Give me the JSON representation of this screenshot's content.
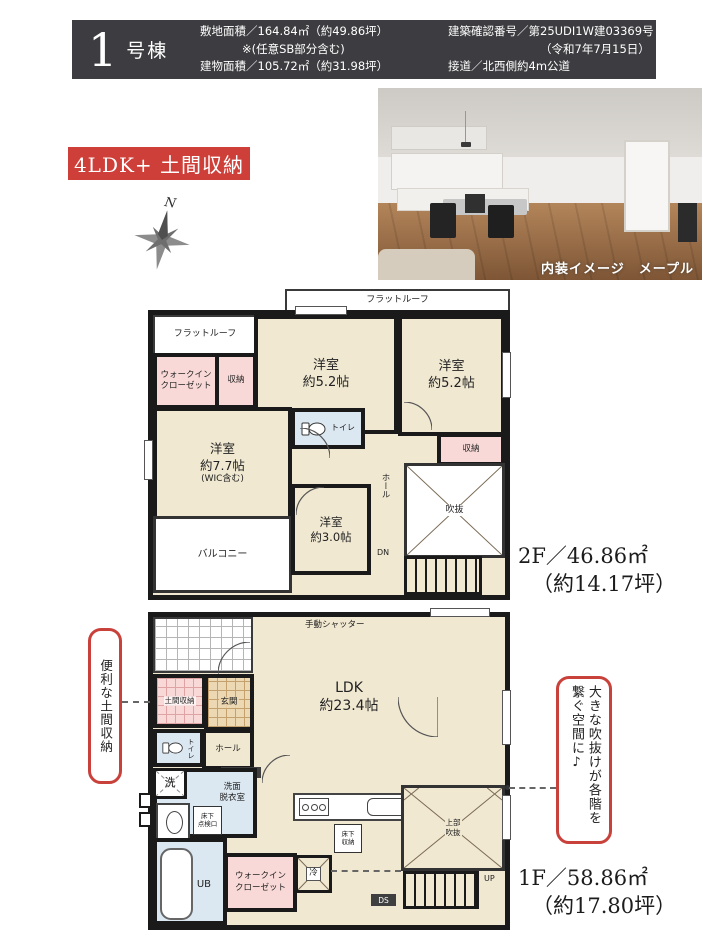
{
  "header": {
    "unit_number": "1",
    "unit_suffix": "号棟",
    "site_area": "敷地面積／164.84㎡（約49.86坪）",
    "site_area_note": "※(任意SB部分含む)",
    "building_area": "建物面積／105.72㎡（約31.98坪）",
    "confirm_no": "建築確認番号／第25UDI1W建03369号",
    "confirm_date": "（令和7年7月15日）",
    "road": "接道／北西側約4m公道"
  },
  "plan_badge": "4LDK+ 土間収納",
  "compass_n": "N",
  "photo_caption": "内装イメージ　メープル",
  "floor2": {
    "flat_roof_left": "フラットルーフ",
    "flat_roof_top": "フラットルーフ",
    "wic": "ウォークイン\nクローゼット",
    "closet_left": "収納",
    "bedroom52_left": "洋室\n約5.2帖",
    "bedroom52_right": "洋室\n約5.2帖",
    "toilet": "トイレ",
    "bedroom77": "洋室\n約7.7帖",
    "bedroom77_note": "(WIC含む)",
    "balcony": "バルコニー",
    "bedroom30": "洋室\n約3.0帖",
    "hall": "ホール",
    "closet_right": "収納",
    "void": "吹抜",
    "dn": "DN",
    "area1": "2F／46.86㎡",
    "area2": "（約14.17坪）"
  },
  "floor1": {
    "shutter": "手動シャッター",
    "ldk": "LDK\n約23.4帖",
    "doma": "土間収納",
    "genkan": "玄関",
    "toilet": "トイレ",
    "hall": "ホール",
    "genkan_storage": "玄関収納",
    "wash": "洗",
    "sanitary": "洗面\n脱衣室",
    "hatch": "床下\n点検口",
    "ub": "UB",
    "wic": "ウォークイン\nクローゼット",
    "fridge": "冷",
    "underfloor_storage": "床下\n収納",
    "void_upper": "上部\n吹抜",
    "up": "UP",
    "ds": "DS",
    "area1": "1F／58.86㎡",
    "area2": "（約17.80坪）"
  },
  "callout_left": "便利な土間収納",
  "callout_right": "大きな吹抜けが各階を繋ぐ空間に♪",
  "colors": {
    "accent_red": "#cf3f39",
    "header_bg": "#3d3d41",
    "wall": "#1a1a1a",
    "room_beige": "#f0e8d1",
    "room_pink": "#f8d9d7",
    "room_blue": "#dce8f1",
    "genkan_tan": "#ecd8b2"
  }
}
